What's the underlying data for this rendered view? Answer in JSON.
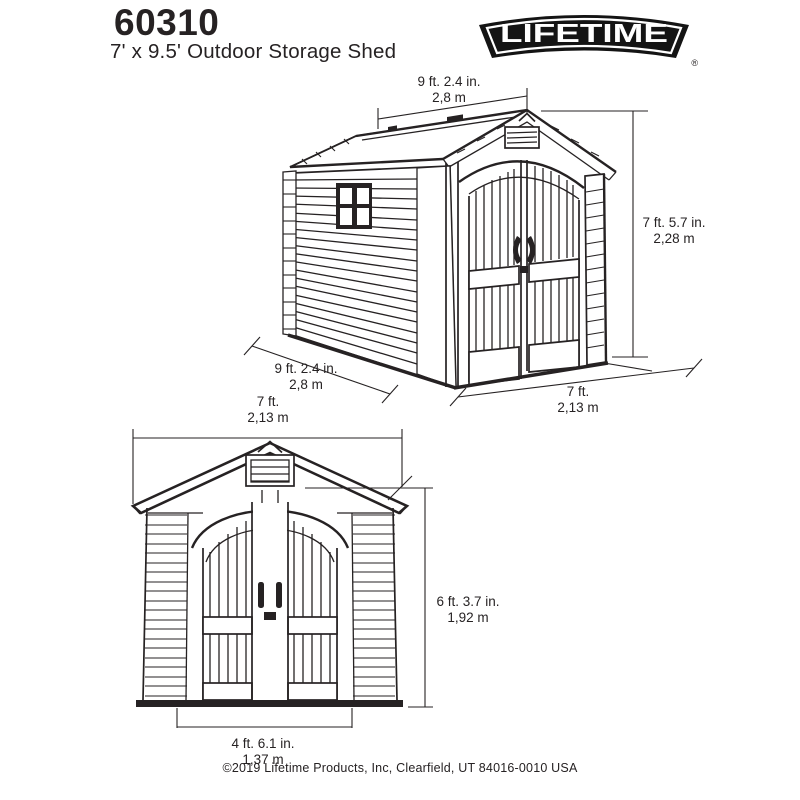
{
  "header": {
    "model": "60310",
    "subtitle": "7' x 9.5' Outdoor Storage Shed",
    "logo_text": "LIFETIME",
    "registered_mark": "®"
  },
  "perspective_view": {
    "depth_top_imperial": "9 ft. 2.4 in.",
    "depth_top_metric": "2,8 m",
    "height_imperial": "7 ft. 5.7 in.",
    "height_metric": "2,28 m",
    "depth_bottom_imperial": "9 ft. 2.4 in.",
    "depth_bottom_metric": "2,8 m",
    "width_imperial": "7 ft.",
    "width_metric": "2,13 m"
  },
  "front_view": {
    "width_imperial": "7 ft.",
    "width_metric": "2,13 m",
    "height_imperial": "6 ft. 3.7 in.",
    "height_metric": "1,92 m",
    "door_width_imperial": "4 ft. 6.1 in.",
    "door_width_metric": "1,37 m"
  },
  "footer": {
    "copyright": "©2019 Lifetime Products, Inc, Clearfield, UT 84016-0010 USA"
  },
  "colors": {
    "line": "#262223",
    "background": "#ffffff",
    "logo": "#141414"
  }
}
